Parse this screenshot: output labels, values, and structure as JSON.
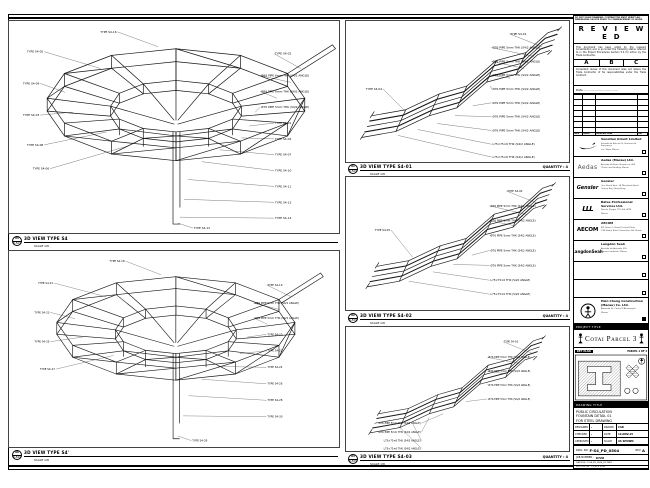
{
  "sheet": {
    "views": [
      {
        "bubble": "05",
        "ref": "S-501",
        "title": "3D VIEW TYPE S4",
        "scale": "SCALE 1/8",
        "qty": ""
      },
      {
        "bubble": "06",
        "ref": "S-501",
        "title": "3D VIEW TYPE S4'",
        "scale": "SCALE 1/8",
        "qty": ""
      },
      {
        "bubble": "01",
        "ref": "S-501",
        "title": "3D VIEW TYPE S4-01",
        "scale": "SCALE 1/8",
        "qty": "QUANTITY : 4"
      },
      {
        "bubble": "02",
        "ref": "S-501",
        "title": "3D VIEW TYPE S4-02",
        "scale": "SCALE 1/8",
        "qty": "QUANTITY : 4"
      },
      {
        "bubble": "03",
        "ref": "S-501",
        "title": "3D VIEW TYPE S4-03",
        "scale": "SCALE 1/8",
        "qty": "QUANTITY : 4"
      }
    ],
    "labels": {
      "va": [
        {
          "t": "TYPE S4-16",
          "x": 108,
          "y": 12,
          "px": 150,
          "py": 26,
          "a": "e"
        },
        {
          "t": "TYPE S4-05",
          "x": 34,
          "y": 32,
          "px": 92,
          "py": 48,
          "a": "e"
        },
        {
          "t": "TYPE S4-09",
          "x": 30,
          "y": 64,
          "px": 56,
          "py": 72,
          "a": "e"
        },
        {
          "t": "TYPE S4-03",
          "x": 30,
          "y": 96,
          "px": 64,
          "py": 92,
          "a": "e"
        },
        {
          "t": "TYPE S4-08",
          "x": 34,
          "y": 126,
          "px": 98,
          "py": 112,
          "a": "e"
        },
        {
          "t": "TYPE S4-06",
          "x": 40,
          "y": 150,
          "px": 120,
          "py": 126,
          "a": "e"
        },
        {
          "t": "TYPE S4-02",
          "x": 268,
          "y": 34,
          "px": 294,
          "py": 48,
          "a": "s"
        },
        {
          "t": "Ø89 PIPE 6mm THK (S4/2 ANGLE)",
          "x": 254,
          "y": 56,
          "px": 284,
          "py": 62,
          "a": "s"
        },
        {
          "t": "Ø89 PIPE 6mm THK (S4/2 ANGLE)",
          "x": 254,
          "y": 72,
          "px": 270,
          "py": 78,
          "a": "s"
        },
        {
          "t": "Ø76 PIPE 5mm THK (S4/2 ANGLE)",
          "x": 254,
          "y": 88,
          "px": 248,
          "py": 92,
          "a": "s"
        },
        {
          "t": "TYPE S4-01",
          "x": 268,
          "y": 104,
          "px": 242,
          "py": 106,
          "a": "s"
        },
        {
          "t": "TYPE S4-04",
          "x": 268,
          "y": 120,
          "px": 234,
          "py": 118,
          "a": "s"
        },
        {
          "t": "TYPE S4-07",
          "x": 268,
          "y": 136,
          "px": 212,
          "py": 130,
          "a": "s"
        },
        {
          "t": "TYPE S4-10",
          "x": 268,
          "y": 152,
          "px": 194,
          "py": 142,
          "a": "s"
        },
        {
          "t": "TYPE S4-11",
          "x": 268,
          "y": 168,
          "px": 180,
          "py": 160,
          "a": "s"
        },
        {
          "t": "TYPE S4-13",
          "x": 268,
          "y": 184,
          "px": 176,
          "py": 180,
          "a": "s"
        },
        {
          "t": "TYPE S4-14",
          "x": 268,
          "y": 200,
          "px": 172,
          "py": 198,
          "a": "s"
        },
        {
          "t": "TYPE S4-12",
          "x": 186,
          "y": 210,
          "px": 170,
          "py": 204,
          "a": "s"
        }
      ],
      "vb": [
        {
          "t": "TYPE S4-18",
          "x": 112,
          "y": 12,
          "px": 152,
          "py": 26,
          "a": "e"
        },
        {
          "t": "TYPE S4-21",
          "x": 34,
          "y": 36,
          "px": 92,
          "py": 50,
          "a": "e"
        },
        {
          "t": "TYPE S4-23",
          "x": 30,
          "y": 68,
          "px": 58,
          "py": 74,
          "a": "e"
        },
        {
          "t": "TYPE S4-25",
          "x": 30,
          "y": 100,
          "px": 66,
          "py": 94,
          "a": "e"
        },
        {
          "t": "TYPE S4-27",
          "x": 36,
          "y": 130,
          "px": 100,
          "py": 114,
          "a": "e"
        },
        {
          "t": "TYPE S4-19",
          "x": 268,
          "y": 38,
          "px": 294,
          "py": 50,
          "a": "s"
        },
        {
          "t": "Ø89 PIPE 6mm THK (S4/2 ANGLE)",
          "x": 254,
          "y": 58,
          "px": 282,
          "py": 64,
          "a": "s"
        },
        {
          "t": "Ø76 PIPE 5mm THK (S4/2 ANGLE)",
          "x": 254,
          "y": 74,
          "px": 268,
          "py": 80,
          "a": "s"
        },
        {
          "t": "TYPE S4-20",
          "x": 268,
          "y": 92,
          "px": 246,
          "py": 94,
          "a": "s"
        },
        {
          "t": "TYPE S4-22",
          "x": 268,
          "y": 110,
          "px": 238,
          "py": 112,
          "a": "s"
        },
        {
          "t": "TYPE S4-24",
          "x": 268,
          "y": 128,
          "px": 214,
          "py": 126,
          "a": "s"
        },
        {
          "t": "TYPE S4-26",
          "x": 268,
          "y": 146,
          "px": 196,
          "py": 140,
          "a": "s"
        },
        {
          "t": "TYPE S4-28",
          "x": 268,
          "y": 164,
          "px": 182,
          "py": 158,
          "a": "s"
        },
        {
          "t": "TYPE S4-30",
          "x": 268,
          "y": 182,
          "px": 176,
          "py": 180,
          "a": "s"
        },
        {
          "t": "TYPE S4-29",
          "x": 186,
          "y": 208,
          "px": 170,
          "py": 202,
          "a": "s"
        }
      ],
      "vc": [
        {
          "t": "TYPE S4-01",
          "x": 166,
          "y": 14,
          "px": 198,
          "py": 26,
          "a": "s"
        },
        {
          "t": "Ø76 PIPE 5mm THK (S4/2 ANGLE)",
          "x": 148,
          "y": 28,
          "px": 190,
          "py": 36,
          "a": "s"
        },
        {
          "t": "Ø76 PIPE 5mm THK (S4/2 ANGLE)",
          "x": 148,
          "y": 42,
          "px": 180,
          "py": 48,
          "a": "s"
        },
        {
          "t": "Ø76 PIPE 5mm THK (S4/2 ANGLE)",
          "x": 148,
          "y": 56,
          "px": 166,
          "py": 58,
          "a": "s"
        },
        {
          "t": "Ø76 PIPE 5mm THK (S4/2 ANGLE)",
          "x": 148,
          "y": 70,
          "px": 146,
          "py": 66,
          "a": "s"
        },
        {
          "t": "Ø76 PIPE 5mm THK (S4/2 ANGLE)",
          "x": 148,
          "y": 84,
          "px": 128,
          "py": 86,
          "a": "s"
        },
        {
          "t": "Ø76 PIPE 5mm THK (S4/2 ANGLE)",
          "x": 148,
          "y": 98,
          "px": 110,
          "py": 96,
          "a": "s"
        },
        {
          "t": "Ø76 PIPE 5mm THK (S4/2 ANGLE)",
          "x": 148,
          "y": 112,
          "px": 92,
          "py": 104,
          "a": "s"
        },
        {
          "t": "L75×75×6 THK (S4/2 ANGLE)",
          "x": 148,
          "y": 126,
          "px": 72,
          "py": 110,
          "a": "s"
        },
        {
          "t": "L75×75×6 THK (S4/2 ANGLE)",
          "x": 148,
          "y": 139,
          "px": 52,
          "py": 116,
          "a": "s"
        },
        {
          "t": "TYPE S4-04",
          "x": 36,
          "y": 70,
          "px": 60,
          "py": 92,
          "a": "e"
        }
      ],
      "vd": [
        {
          "t": "TYPE S4-02",
          "x": 166,
          "y": 16,
          "px": 198,
          "py": 28,
          "a": "s"
        },
        {
          "t": "Ø76 PIPE 5mm THK (S4/2 ANGLE)",
          "x": 148,
          "y": 32,
          "px": 186,
          "py": 40,
          "a": "s"
        },
        {
          "t": "Ø76 PIPE 5mm THK (S4/2 ANGLE)",
          "x": 148,
          "y": 48,
          "px": 172,
          "py": 52,
          "a": "s"
        },
        {
          "t": "Ø76 PIPE 5mm THK (S4/2 ANGLE)",
          "x": 148,
          "y": 64,
          "px": 150,
          "py": 62,
          "a": "s"
        },
        {
          "t": "Ø76 PIPE 5mm THK (S4/2 ANGLE)",
          "x": 148,
          "y": 80,
          "px": 128,
          "py": 84,
          "a": "s"
        },
        {
          "t": "Ø76 PIPE 5mm THK (S4/2 ANGLE)",
          "x": 148,
          "y": 96,
          "px": 108,
          "py": 94,
          "a": "s"
        },
        {
          "t": "L75×75×6 THK (S4/2 ANGLE)",
          "x": 148,
          "y": 112,
          "px": 86,
          "py": 102,
          "a": "s"
        },
        {
          "t": "L75×75×6 THK (S4/2 ANGLE)",
          "x": 148,
          "y": 127,
          "px": 60,
          "py": 112,
          "a": "s"
        },
        {
          "t": "TYPE S4-05",
          "x": 40,
          "y": 58,
          "px": 64,
          "py": 86,
          "a": "e"
        }
      ],
      "ve": [
        {
          "t": "TYPE S4-03",
          "x": 166,
          "y": 18,
          "px": 198,
          "py": 30,
          "a": "s"
        },
        {
          "t": "Ø76 PIPE 5mm THK (S4/2 ANGLE)",
          "x": 148,
          "y": 36,
          "px": 184,
          "py": 42,
          "a": "s"
        },
        {
          "t": "Ø76 PIPE 5mm THK (S4/2 ANGLE)",
          "x": 148,
          "y": 52,
          "px": 168,
          "py": 54,
          "a": "s"
        },
        {
          "t": "Ø76 PIPE 5mm THK (S4/2 ANGLE)",
          "x": 148,
          "y": 68,
          "px": 146,
          "py": 66,
          "a": "s"
        },
        {
          "t": "Ø76 PIPE 5mm THK (S4/2 ANGLE)",
          "x": 148,
          "y": 84,
          "px": 122,
          "py": 86,
          "a": "s"
        },
        {
          "t": "Ø76 PIPE 5mm THK (S4/2 ANGLE)",
          "x": 70,
          "y": 112,
          "px": 96,
          "py": 100,
          "a": "e"
        },
        {
          "t": "Ø76 PIPE 5mm THK (S4/2 ANGLE)",
          "x": 70,
          "y": 122,
          "px": 80,
          "py": 104,
          "a": "e"
        },
        {
          "t": "L75×75×6 THK (S4/2 ANGLE)",
          "x": 70,
          "y": 132,
          "px": 60,
          "py": 110,
          "a": "e"
        },
        {
          "t": "L75×75×6 THK (S4/2 ANGLE)",
          "x": 70,
          "y": 141,
          "px": 44,
          "py": 114,
          "a": "e"
        }
      ]
    }
  },
  "titleblock": {
    "note": "DO NOT SCALE DRAWING. CONTRACTOR MUST VERIFY ALL DIMENSIONS ON SITE PRIOR TO COMMENCEMENT OF WORK.",
    "reviewed": {
      "title": "R E V I E W E D",
      "para1": "This document has been noted by the relevant Consultant(s) and is accorded the following status referred to in the Project Procedures Section 5.4 for action by the Trade Contractor.",
      "statuses": [
        "A",
        "B",
        "C"
      ],
      "para2": "Consultant review of this document does not relieve the Trade Contractor of his responsibilities under the Trade Contract.",
      "date_label": "Date : ....................................."
    },
    "rev_headers": [
      "REV",
      "DATE",
      "DESCRIPTION",
      "INT"
    ],
    "companies": [
      {
        "logotext": "",
        "name": "Venetian Orient Limited",
        "l1": "Estrada da Baía de N. Senhora da Esperança",
        "l2": "s/n, Taipa, Macau"
      },
      {
        "logotext": "Aedas",
        "name": "Aedas (Macau) Ltd.",
        "l1": "Avenida da Praia Grande no. 409",
        "l2": "China Law Building, Macau"
      },
      {
        "logotext": "Gensler",
        "name": "Gensler",
        "l1": "One Island East, 18 Westlands Road",
        "l2": "Quarry Bay, Hong Kong"
      },
      {
        "logotext": "LLL",
        "name": "Bates Professional Services Ltd.",
        "l1": "Rua de Xangai 175, Edf. ACM",
        "l2": "Macau"
      },
      {
        "logotext": "AECOM",
        "name": "AECOM",
        "l1": "8/F Tower 2, Grand Central Plaza",
        "l2": "138 Shatin Rural Committee Rd, Shatin"
      },
      {
        "logotext": "LangdonSeah",
        "name": "Langdon Seah",
        "l1": "Avenida da Amizade 555",
        "l2": "Macau Landmark, Macau"
      }
    ],
    "contractor": {
      "name": "Hsin Chong Construction",
      "name2": "(Macau) Co. Ltd.",
      "l1": "Alameda Dr. Carlos D'Assumpção",
      "l2": "Macau"
    },
    "project_title_label": "PROJECT TITLE",
    "project_title": "Cotai Parcel 3",
    "key_plan_label": "KEY PLAN",
    "parcel_note": "PARCEL 1 OF 3",
    "drawing_title_label": "DRAWING TITLE",
    "drawing_title_lines": [
      "PUBLIC CIRCULATION",
      "FOUNTAIN DETAIL 01",
      "FOR STEEL DRAWING"
    ],
    "fields": {
      "designed_l": "DESIGNED",
      "designed_v": "-",
      "drawn_l": "DRAWN",
      "drawn_v": "CAD",
      "checked_l": "CHECKED",
      "checked_v": "-",
      "date_l": "DATE",
      "date_v": "12-NOV-15",
      "approved_l": "APPROVED",
      "approved_v": "-",
      "scale_l": "SCALE",
      "scale_v": "AS SHOWN"
    },
    "dwg": {
      "label": "DWG. NO.",
      "value": "F-S4_PD_0504",
      "rev_label": "REV.",
      "rev": "A"
    },
    "job": {
      "label": "JOB NUMBER :",
      "value": "0720"
    },
    "file_line": "CAD FILE : F-S4_PD_0504_R1.DWG",
    "printed_line": "PLOTTED ON : 12 NOV 2015"
  }
}
